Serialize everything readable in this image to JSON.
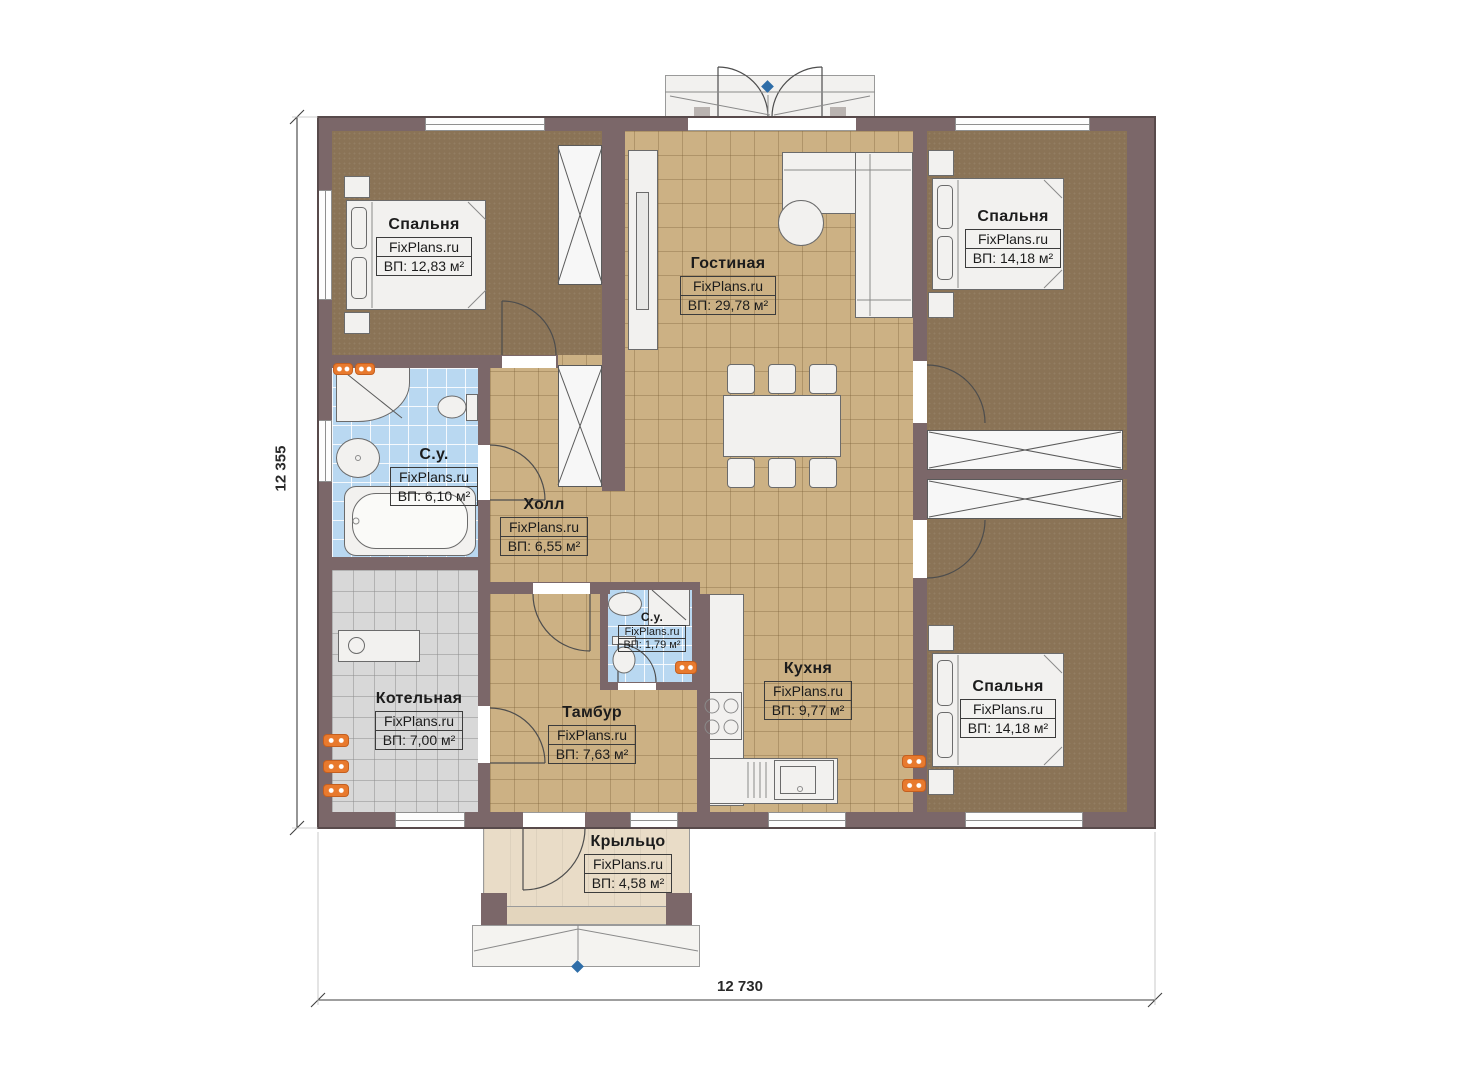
{
  "plan": {
    "watermark": "FixPlans.ru",
    "rooms": {
      "bedroom_tl": {
        "name": "Спальня",
        "area": "ВП: 12,83 м²"
      },
      "living": {
        "name": "Гостиная",
        "area": "ВП: 29,78 м²"
      },
      "bedroom_tr": {
        "name": "Спальня",
        "area": "ВП: 14,18 м²"
      },
      "bathroom": {
        "name": "С.у.",
        "area": "ВП: 6,10 м²"
      },
      "hall": {
        "name": "Холл",
        "area": "ВП: 6,55 м²"
      },
      "wc": {
        "name": "С.у.",
        "area": "ВП: 1,79 м²"
      },
      "boiler": {
        "name": "Котельная",
        "area": "ВП: 7,00 м²"
      },
      "vestibule": {
        "name": "Тамбур",
        "area": "ВП: 7,63 м²"
      },
      "kitchen": {
        "name": "Кухня",
        "area": "ВП: 9,77 м²"
      },
      "bedroom_br": {
        "name": "Спальня",
        "area": "ВП: 14,18 м²"
      },
      "porch": {
        "name": "Крыльцо",
        "area": "ВП: 4,58 м²"
      }
    },
    "dimensions": {
      "left": "12 355",
      "bottom": "12 730"
    },
    "colors": {
      "wall": "#7b6769",
      "tile_tan": "#ccb184",
      "tile_blue": "#b9d8f1",
      "tile_gray": "#d8d8d8",
      "carpet": "#8a7356",
      "radiator": "#e87a2e",
      "marker": "#2e6da8",
      "porch_floor": "#e9dcc7"
    }
  }
}
